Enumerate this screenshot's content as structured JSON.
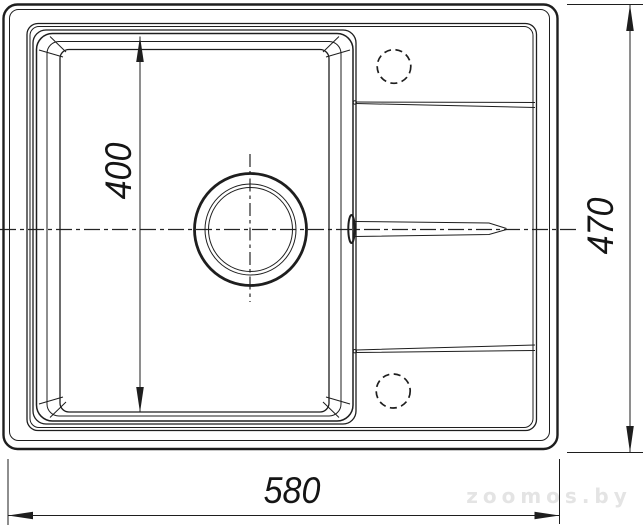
{
  "drawing": {
    "background_color": "#ffffff",
    "line_color": "#1e1e1e",
    "watermark_color": "#e4e4e4",
    "labels": {
      "bowl_depth": "400",
      "overall_depth": "470",
      "overall_width": "580"
    },
    "watermark": "zoomos.by"
  }
}
